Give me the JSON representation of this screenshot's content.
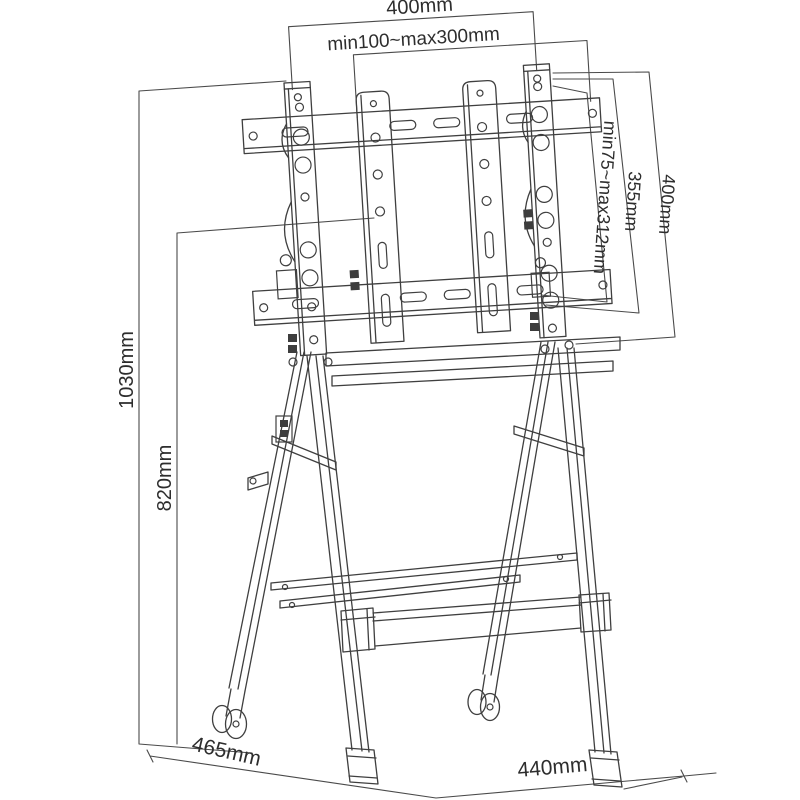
{
  "diagram": {
    "background": "#ffffff",
    "line_color": "#3f3f3f",
    "labels": {
      "top_width": "400mm",
      "mount_width_range": "min100~max300mm",
      "mount_height_range": "min75~max312mm",
      "bracket_height": "355mm",
      "column_length": "400mm",
      "overall_height": "1030mm",
      "frame_height": "820mm",
      "base_depth": "465mm",
      "base_width": "440mm"
    }
  }
}
